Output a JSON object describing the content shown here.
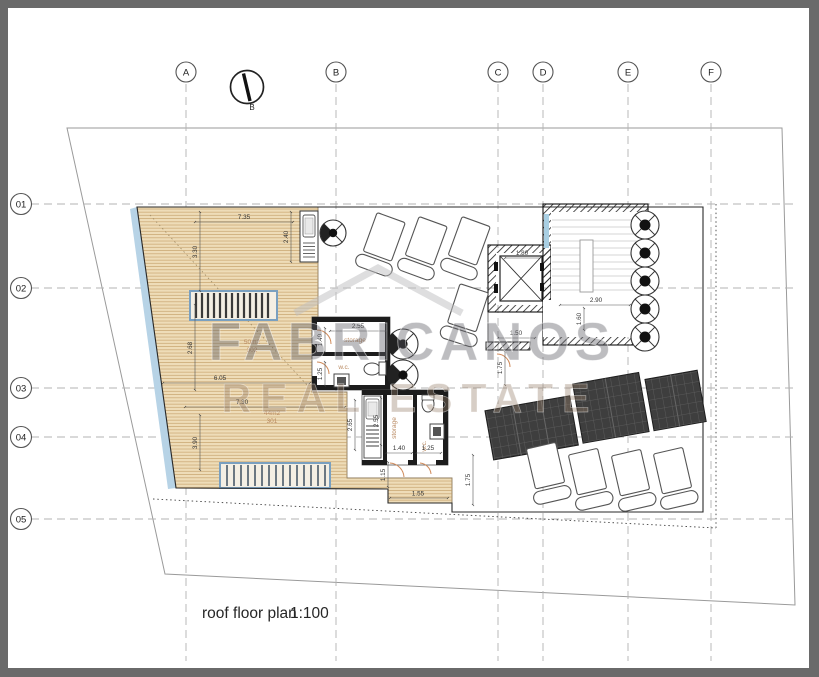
{
  "drawing": {
    "title": "roof floor plan",
    "scale": "1:100"
  },
  "watermark": {
    "line1": "FABRICANOS",
    "line2": "REAL ESTATE"
  },
  "north_label": "B",
  "grid": {
    "columns": [
      {
        "label": "A"
      },
      {
        "label": "B"
      },
      {
        "label": "C"
      },
      {
        "label": "D"
      },
      {
        "label": "E"
      },
      {
        "label": "F"
      }
    ],
    "rows": [
      {
        "label": "01"
      },
      {
        "label": "02"
      },
      {
        "label": "03"
      },
      {
        "label": "04"
      },
      {
        "label": "05"
      }
    ]
  },
  "rooms": {
    "deck_upper": {
      "area": "50m2",
      "number": "302"
    },
    "deck_lower": {
      "area": "44m2",
      "number": "301"
    },
    "storage_upper": "storage",
    "wc_upper": "w.c.",
    "storage_lower": "storage",
    "wc_lower": "w.c."
  },
  "dimensions": {
    "deck_top_width": "7.35",
    "deck_top_height": "3.30",
    "bar_counter": "2.40",
    "deck_mid_height": "2.68",
    "deck_mid_width": "6.05",
    "deck_lower_width": "7.30",
    "deck_lower_height": "3.90",
    "upper_block_width": "2.55",
    "upper_storage_door": "1.40",
    "upper_wc_door": "1.25",
    "elevator_width": "1.80",
    "stair_width": "2.90",
    "stair_flight": "1.60",
    "landing_width": "1.50",
    "landing_height": "1.75",
    "kitchen_depth": "2.65",
    "lower_block_depth": "2.55",
    "lower_storage_door": "1.40",
    "lower_wc_door": "1.25",
    "step_depth": "1.15",
    "step_width": "1.55",
    "terrace_edge": "1.75"
  }
}
